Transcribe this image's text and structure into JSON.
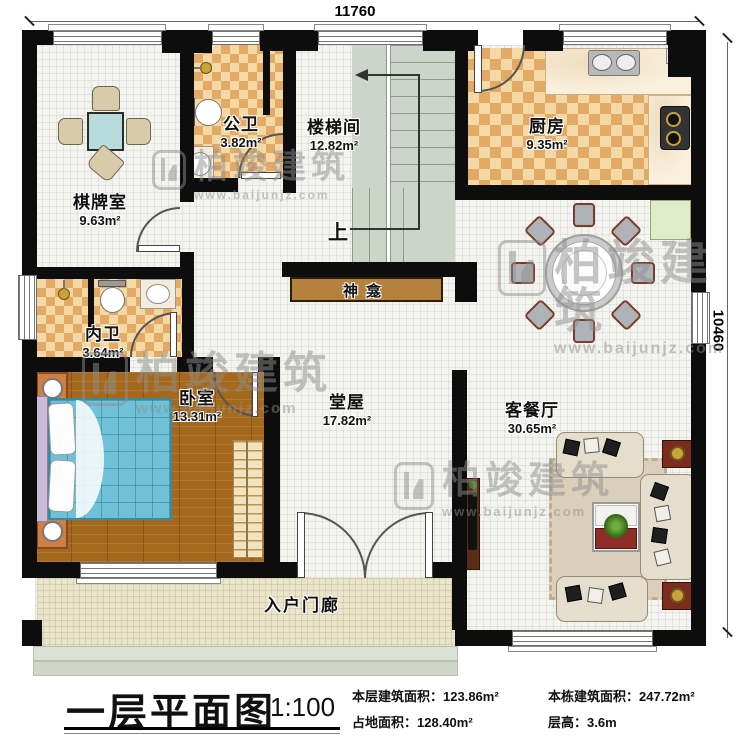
{
  "dimensions": {
    "top": "11760",
    "right": "10460"
  },
  "rooms": {
    "game": {
      "name": "棋牌室",
      "area": "9.63m²"
    },
    "public_bath": {
      "name": "公卫",
      "area": "3.82m²"
    },
    "stairwell": {
      "name": "楼梯间",
      "area": "12.82m²"
    },
    "kitchen": {
      "name": "厨房",
      "area": "9.35m²"
    },
    "inner_bath": {
      "name": "内卫",
      "area": "3.64m²"
    },
    "bedroom": {
      "name": "卧室",
      "area": "13.31m²"
    },
    "hall": {
      "name": "堂屋",
      "area": "17.82m²"
    },
    "living_dining": {
      "name": "客餐厅",
      "area": "30.65m²"
    }
  },
  "annotations": {
    "shrine": "神龛",
    "stairs_up": "上",
    "porch": "入户门廊"
  },
  "titleblock": {
    "title": "一层平面图",
    "scale": "1:100",
    "stats": [
      {
        "label": "本层建筑面积：",
        "value": "123.86m²"
      },
      {
        "label": "本栋建筑面积：",
        "value": "247.72m²"
      },
      {
        "label": "占地面积：",
        "value": "128.40m²"
      },
      {
        "label": "层高：",
        "value": "3.6m"
      }
    ]
  },
  "watermark": {
    "brand": "柏竣建筑",
    "url": "www.baijunjz.com"
  },
  "colors": {
    "wall": "#0d0d0d",
    "checker": "#e3aa66",
    "marble": "#f8efdc",
    "wood": "#a5691e",
    "bed": "#6ec1d6",
    "accent_red": "#8d2f28"
  }
}
